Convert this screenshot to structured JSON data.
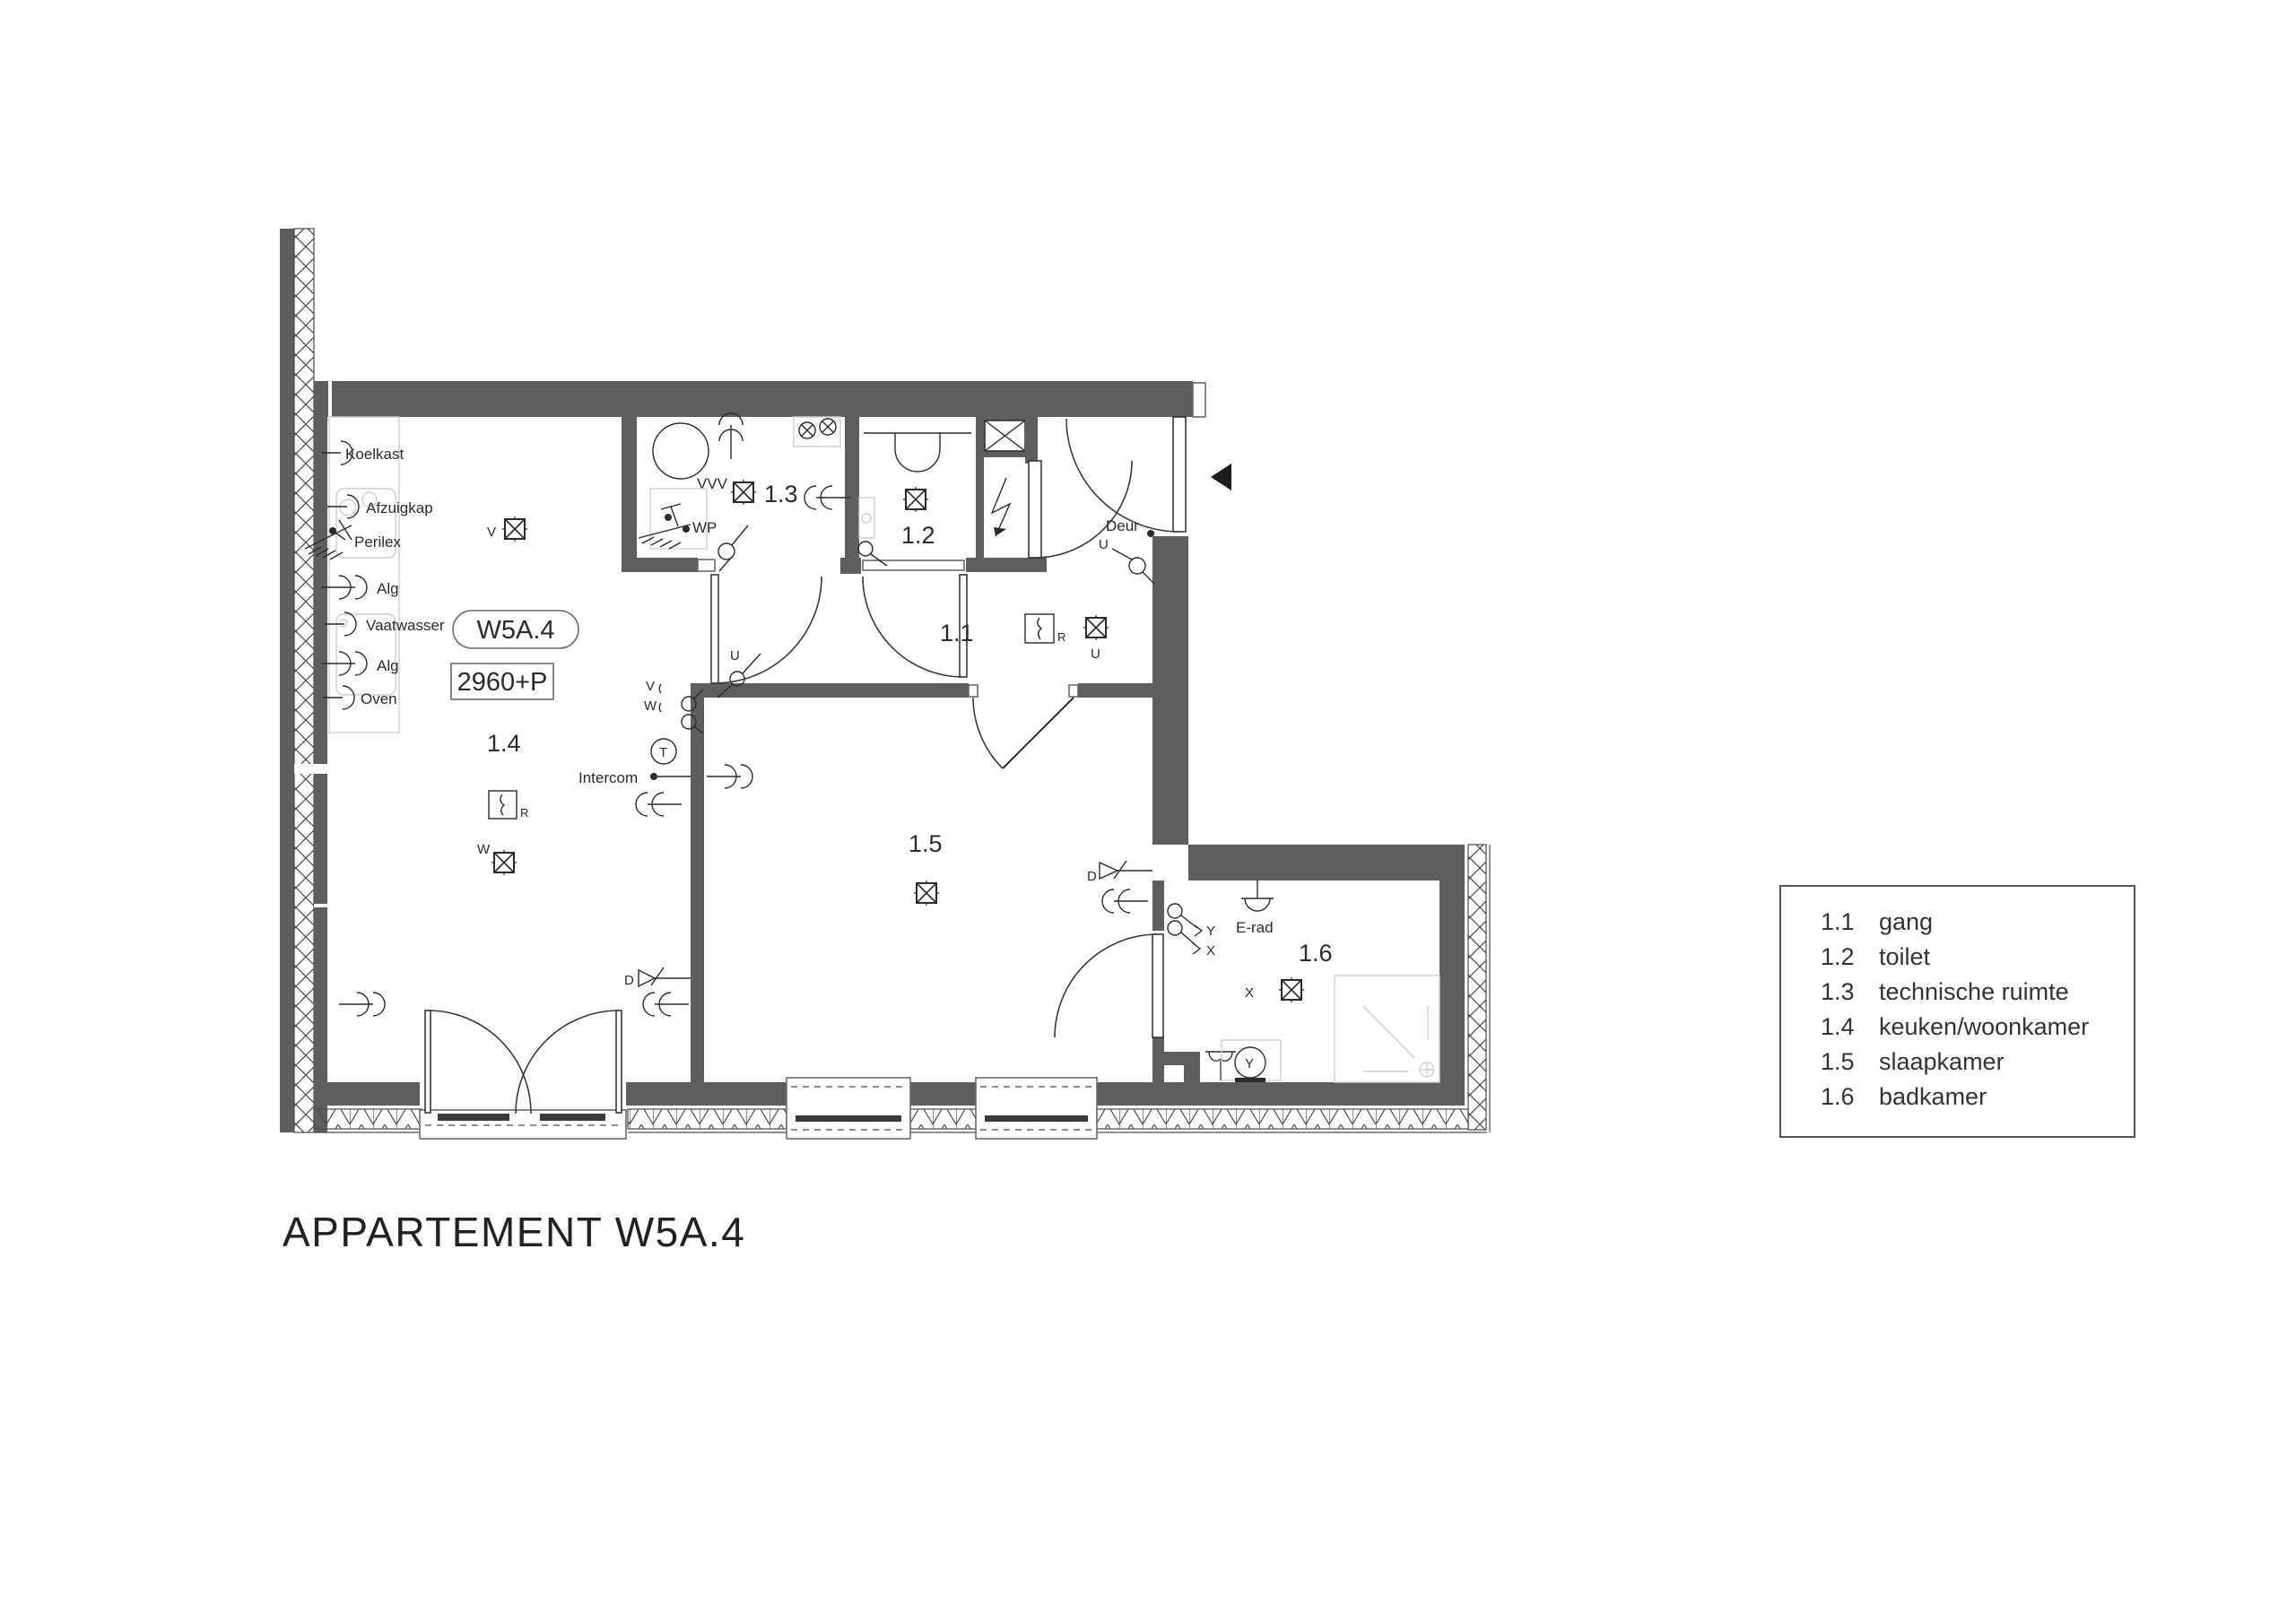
{
  "title": "APPARTEMENT W5A.4",
  "plan": {
    "unit_badge": "W5A.4",
    "level_badge": "2960+P",
    "rooms": {
      "r11": "1.1",
      "r12": "1.2",
      "r13": "1.3",
      "r14": "1.4",
      "r15": "1.5",
      "r16": "1.6"
    },
    "kitchen_labels": [
      "Koelkast",
      "Afzuigkap",
      "Perilex",
      "Alg",
      "Vaatwasser",
      "Alg",
      "Oven"
    ],
    "labels": {
      "vvv": "VVV",
      "wp": "WP",
      "deur": "Deur",
      "intercom": "Intercom",
      "erad": "E-rad",
      "u": "U",
      "v": "V",
      "w": "W",
      "d": "D",
      "x": "X",
      "y": "Y",
      "r": "R",
      "t": "T"
    }
  },
  "legend": {
    "rows": [
      {
        "no": "1.1",
        "name": "gang"
      },
      {
        "no": "1.2",
        "name": "toilet"
      },
      {
        "no": "1.3",
        "name": "technische ruimte"
      },
      {
        "no": "1.4",
        "name": "keuken/woonkamer"
      },
      {
        "no": "1.5",
        "name": "slaapkamer"
      },
      {
        "no": "1.6",
        "name": "badkamer"
      }
    ]
  },
  "colors": {
    "wall": "#5e5e5e",
    "line": "#2b2b2b",
    "light_fixture": "#bdbdbd"
  }
}
